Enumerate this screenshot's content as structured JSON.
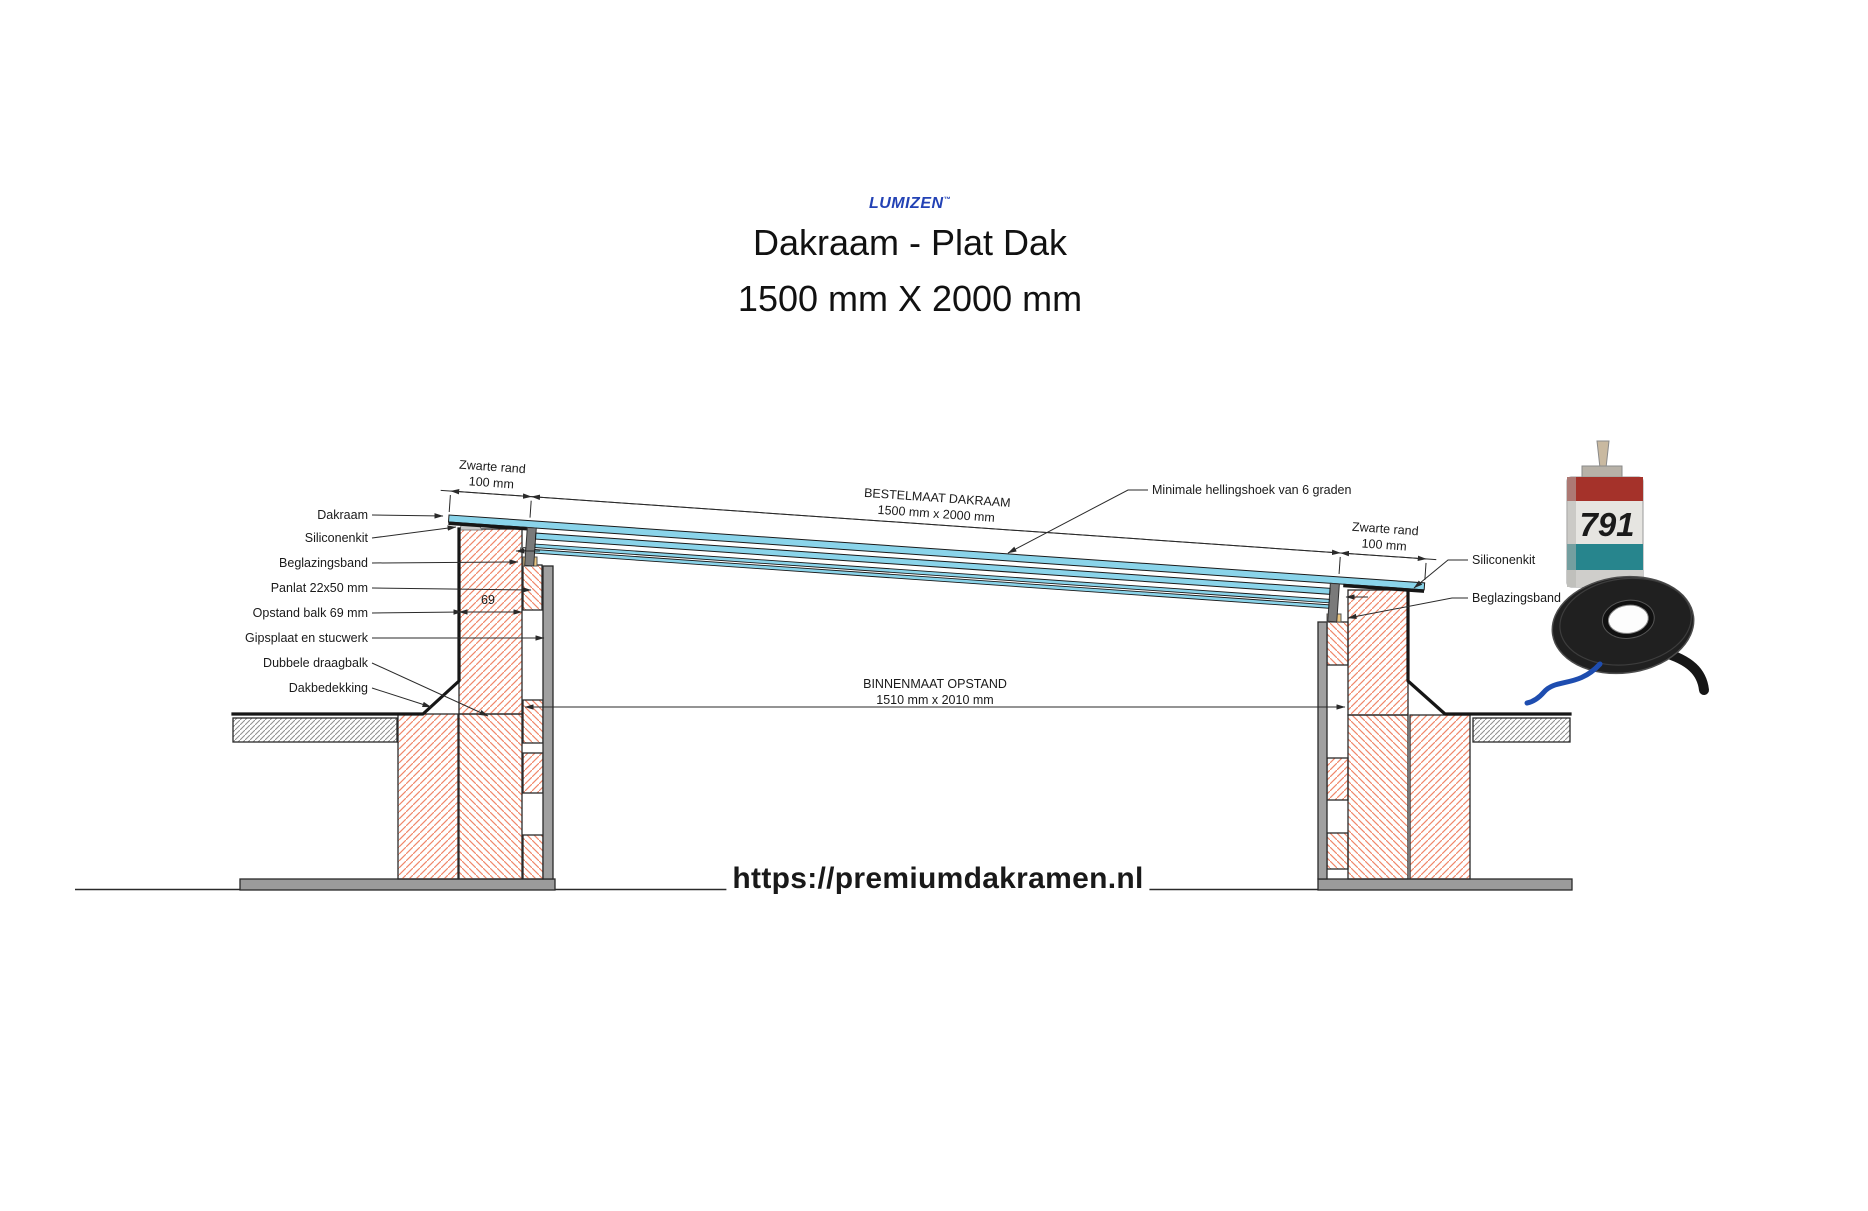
{
  "header": {
    "brand": "LUMIZEN",
    "brand_tm": "™",
    "title": "Dakraam - Plat Dak",
    "subtitle": "1500 mm X 2000 mm"
  },
  "footer": {
    "url": "https://premiumdakramen.nl"
  },
  "drawing": {
    "left_labels": [
      "Dakraam",
      "Siliconenkit",
      "Beglazingsband",
      "Panlat 22x50 mm",
      "Opstand balk 69 mm",
      "Gipsplaat en stucwerk",
      "Dubbele draagbalk",
      "Dakbedekking"
    ],
    "right_labels": [
      "Siliconenkit",
      "Beglazingsband"
    ],
    "annotations": {
      "zwarte_rand_left_1": "Zwarte rand",
      "zwarte_rand_left_2": "100 mm",
      "zwarte_rand_right_1": "Zwarte rand",
      "zwarte_rand_right_2": "100 mm",
      "bestelmaat_1": "BESTELMAAT DAKRAAM",
      "bestelmaat_2": "1500 mm x 2000 mm",
      "binnenmaat_1": "BINNENMAAT OPSTAND",
      "binnenmaat_2": "1510 mm x 2010 mm",
      "hellingshoek": "Minimale hellingshoek van 6 graden",
      "opstand_breedte": "69",
      "glas_detail": "5"
    },
    "products": {
      "cartridge_label": "791"
    },
    "colors": {
      "brand_blue": "#2342b5",
      "glass_blue": "#8ad4ea",
      "hatch_orange": "#f0876a",
      "line_dark": "#2a2a2a",
      "gips_gray": "#a0a0a0",
      "beglazingsband_tan": "#eac57f",
      "siliconenkit_gray": "#c9c9c9",
      "foundation_gray": "#9b9b9b",
      "tape_blue": "#1e4db0",
      "cartridge_red": "#a5322a",
      "cartridge_teal": "#27858d"
    }
  }
}
